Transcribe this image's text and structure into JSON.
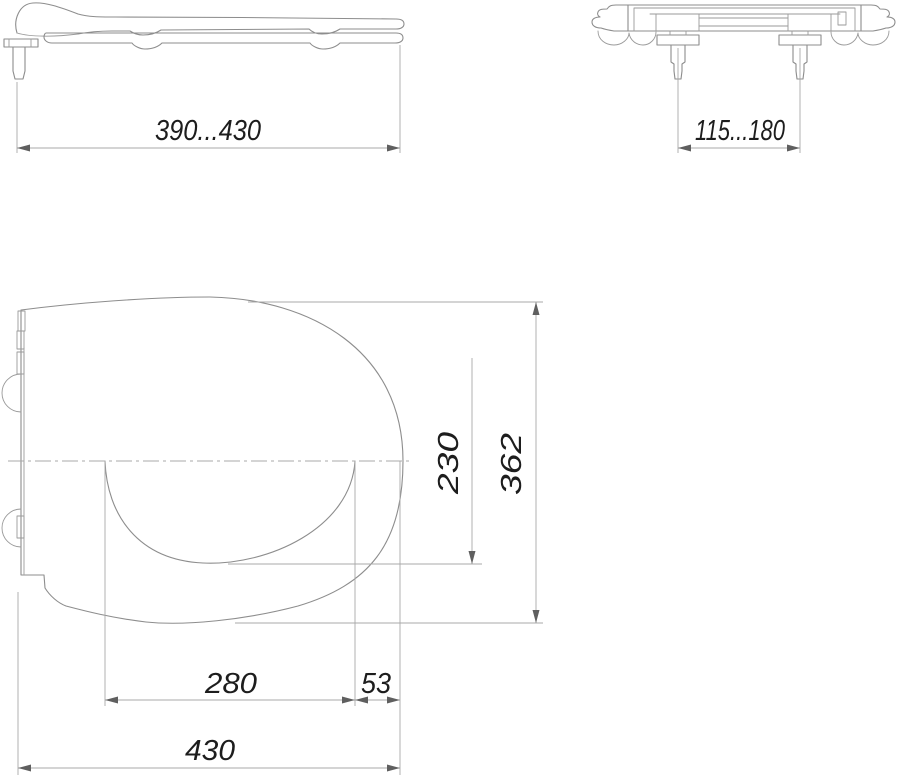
{
  "drawing": {
    "background": "#ffffff",
    "outline_color": "#8d8d8d",
    "thin_line_color": "#a8a8a8",
    "arrow_color": "#5f5f5f",
    "text_color": "#1d1d1d",
    "views": {
      "side": {
        "name": "side-view"
      },
      "rear": {
        "name": "rear-view"
      },
      "plan": {
        "name": "plan-view"
      }
    },
    "dimensions": {
      "length_range": "390...430",
      "bolt_spacing": "115...180",
      "opening_length": "280",
      "front_lip": "53",
      "overall_length": "430",
      "opening_width": "230",
      "overall_width": "362"
    }
  }
}
